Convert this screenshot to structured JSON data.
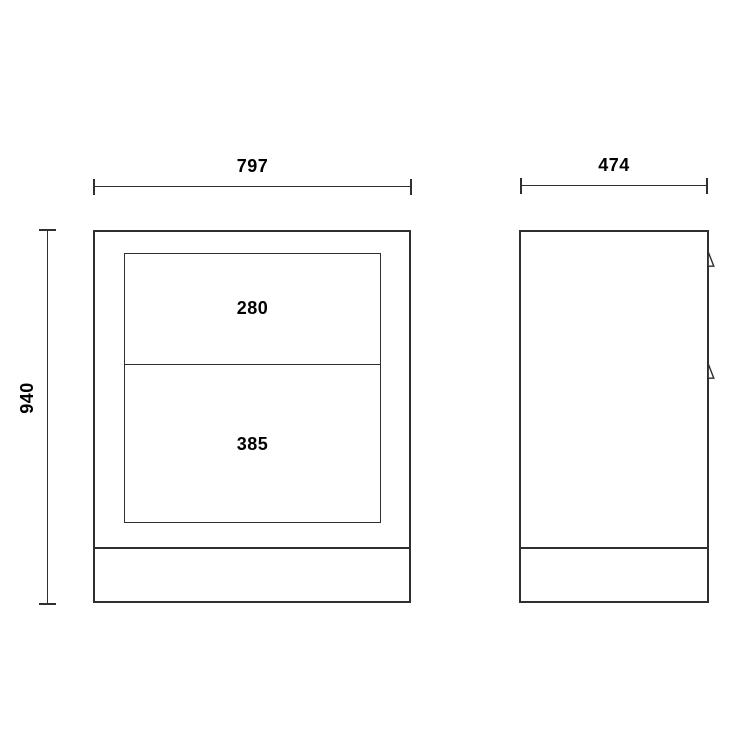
{
  "drawing": {
    "front_view": {
      "width_dimension": "797",
      "height_dimension": "940",
      "drawers": [
        {
          "height_label": "280"
        },
        {
          "height_label": "385"
        }
      ]
    },
    "side_view": {
      "depth_dimension": "474",
      "handle_icon": "drawer-handle-icon",
      "handle_count": "2"
    }
  },
  "colors": {
    "line": "#2f2f2f",
    "text": "#000000",
    "background": "#ffffff"
  }
}
